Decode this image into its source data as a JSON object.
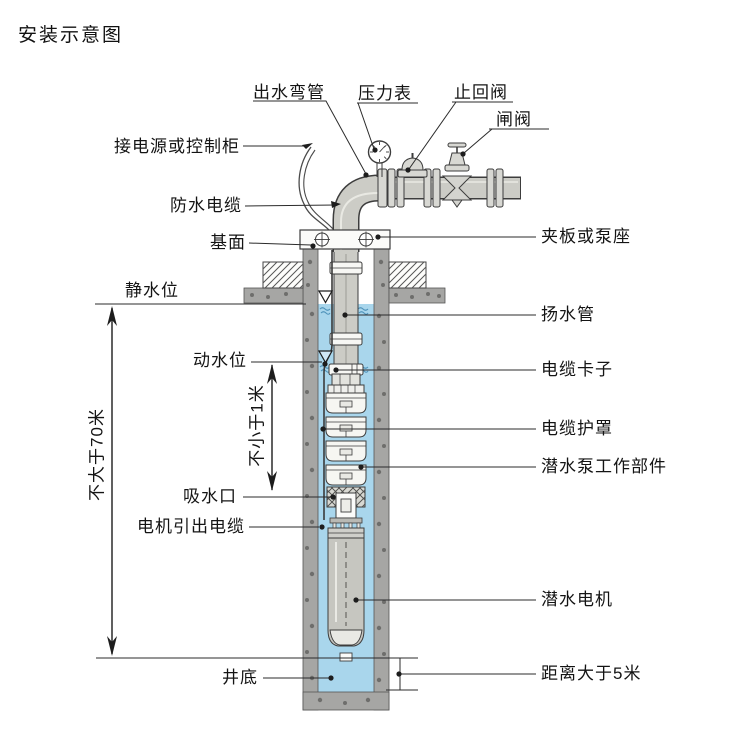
{
  "title": "安装示意图",
  "colors": {
    "water": "#a9d6ec",
    "water_wave": "#4f93ba",
    "wall_gray": "#a6a6a4",
    "wall_speckle": "#6e6e6c",
    "pipe_gray": "#ccccc6",
    "line": "#3d3d3d",
    "pump_body": "#f6f6f2"
  },
  "labels": {
    "top": {
      "outlet_elbow": "出水弯管",
      "pressure_gauge": "压力表",
      "check_valve": "止回阀",
      "gate_valve": "闸阀"
    },
    "left": {
      "power_or_control_cabinet": "接电源或控制柜",
      "waterproof_cable": "防水电缆",
      "base_surface": "基面",
      "static_water_level": "静水位",
      "dynamic_water_level": "动水位",
      "suction_inlet": "吸水口",
      "motor_lead_cable": "电机引出电缆",
      "well_bottom": "井底"
    },
    "right": {
      "clamp_or_pump_seat": "夹板或泵座",
      "riser_pipe": "扬水管",
      "cable_clamp": "电缆卡子",
      "cable_guard": "电缆护罩",
      "pump_working_parts": "潜水泵工作部件",
      "submersible_motor": "潜水电机",
      "distance_over_5m": "距离大于5米"
    },
    "dimensions": {
      "max_depth_70m": "不大于70米",
      "min_1m": "不小于1米"
    }
  }
}
